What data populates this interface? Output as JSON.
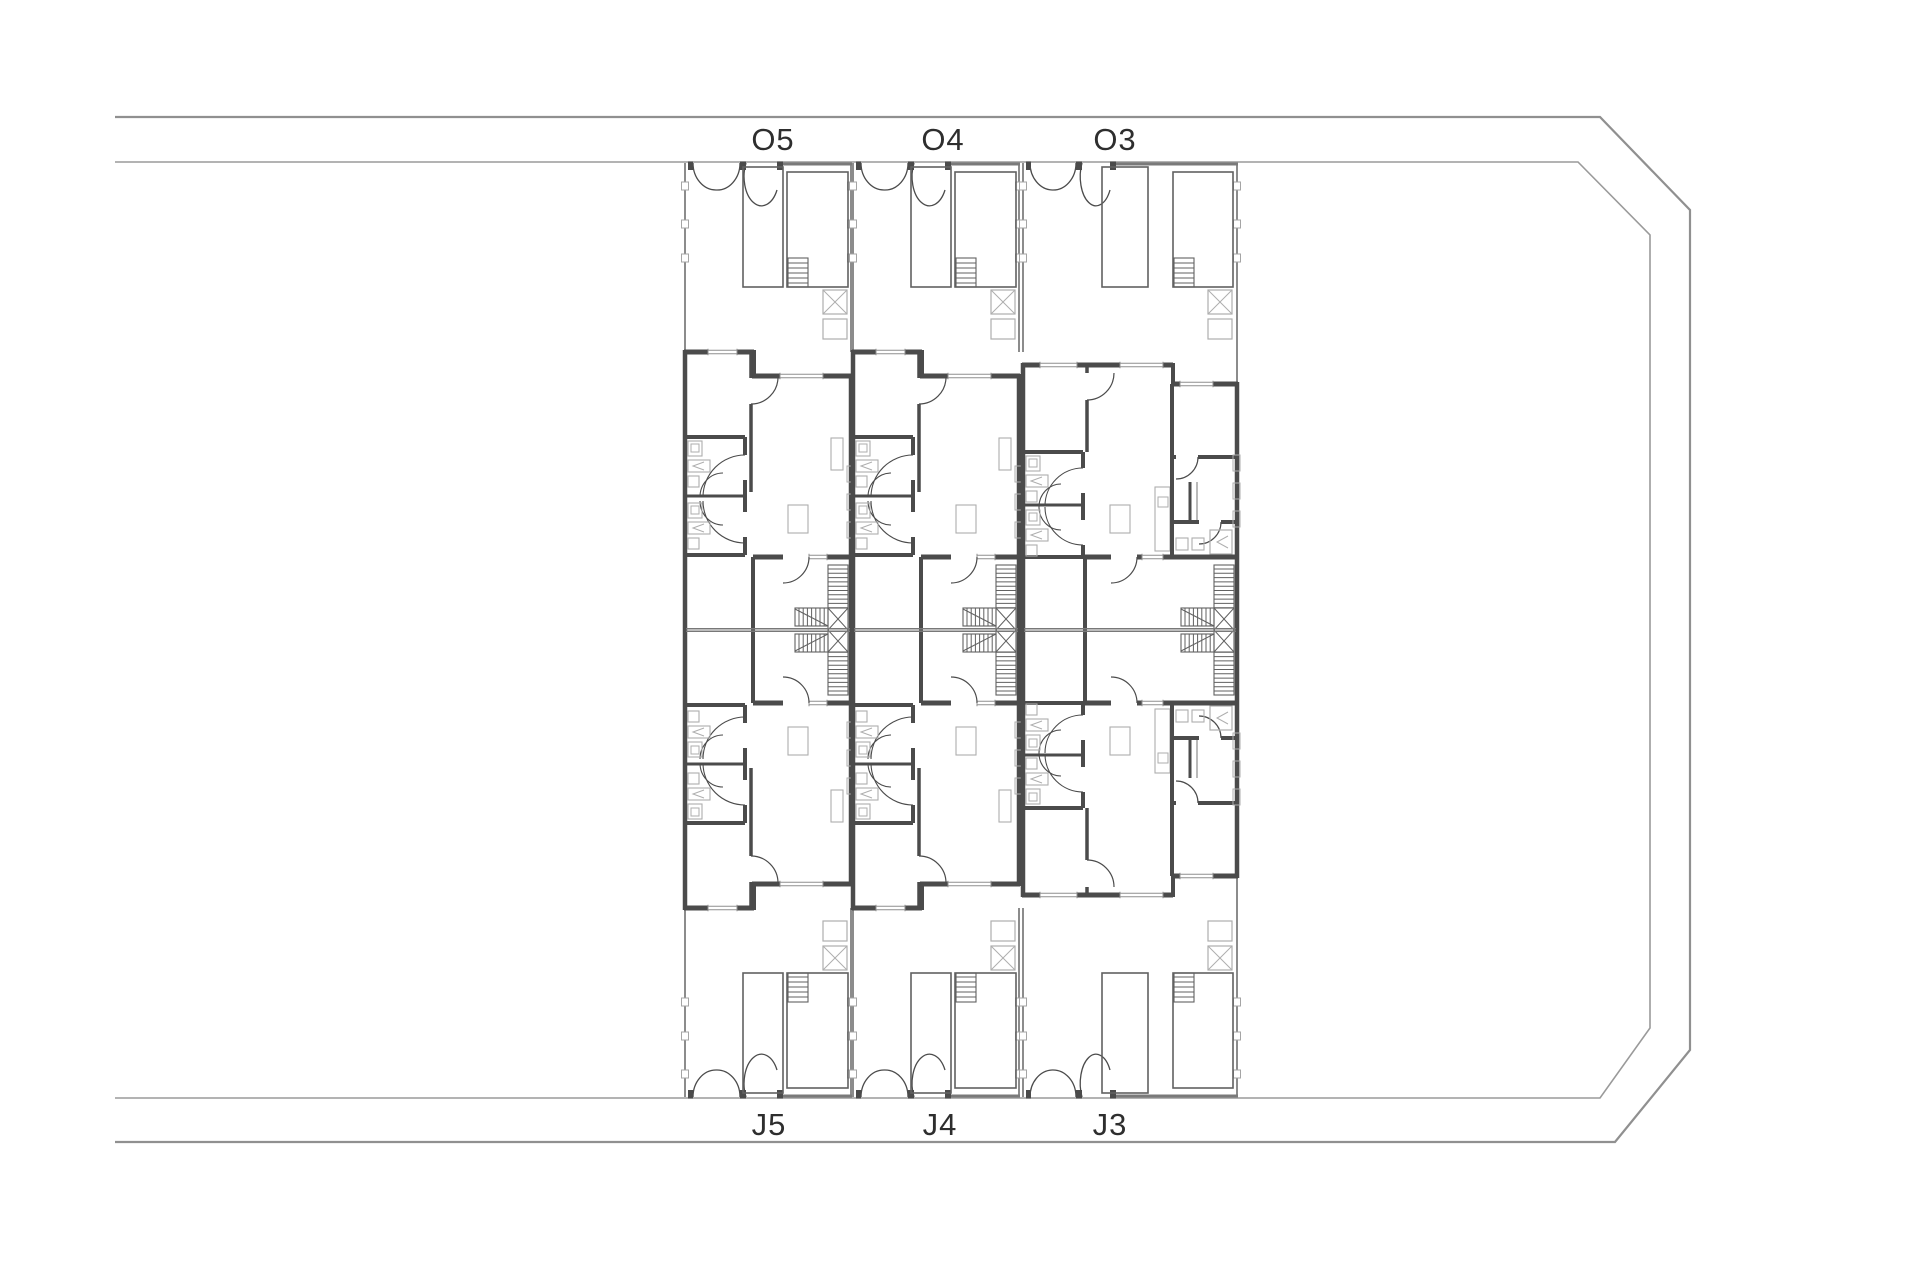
{
  "page": {
    "background": "#ffffff"
  },
  "palette": {
    "wall_dark": "#4b4b4b",
    "wall_medium": "#8c8c8c",
    "pool_line": "#616161",
    "furniture_light": "#aeaeae",
    "window_line": "#8f8f8f",
    "boundary": "#909090",
    "center_line": "#787878",
    "text": "#2e2e2e"
  },
  "plan": {
    "type": "residential-site-floor-plan",
    "units": [
      {
        "id": "unit-1",
        "top_label": "O5",
        "bottom_label": "J5",
        "size": "narrow"
      },
      {
        "id": "unit-2",
        "top_label": "O4",
        "bottom_label": "J4",
        "size": "narrow"
      },
      {
        "id": "unit-3",
        "top_label": "O3",
        "bottom_label": "J3",
        "size": "wide"
      }
    ]
  }
}
